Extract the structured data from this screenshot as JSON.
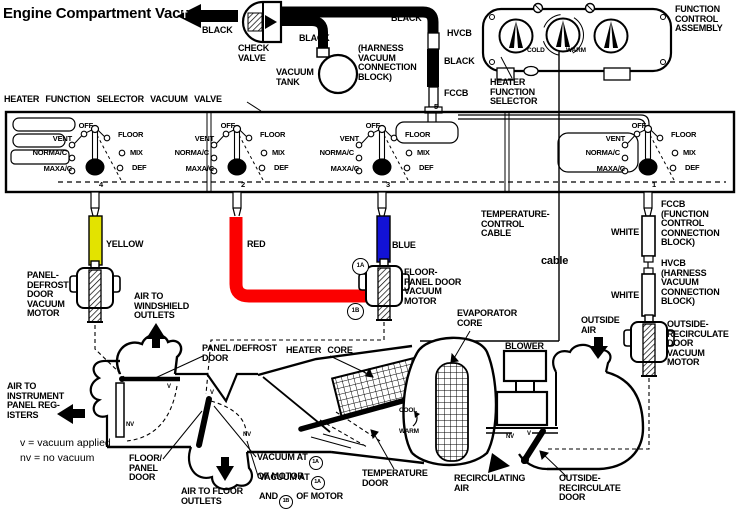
{
  "title": "Engine Compartment Vacuum",
  "colors": {
    "yellow": "#e3e300",
    "red": "#fb0000",
    "blue": "#1212d6",
    "line": "#000000"
  },
  "engine": {
    "arrow_letter": "T",
    "black_hose": "BLACK",
    "check_valve": "CHECK\nVALVE",
    "tank_hose_black": "BLACK",
    "vacuum_tank": "VACUUM\nTANK",
    "harness_block": "(HARNESS\nVACUUM\nCONNECTION\nBLOCK)",
    "supply_black": "BLACK",
    "hvcb": "HVCB",
    "hvcb_black": "BLACK",
    "fccb": "FCCB"
  },
  "control_assembly": {
    "name": "FUNCTION\nCONTROL\nASSEMBLY",
    "cold": "COLD",
    "warm": "WARM",
    "selector": "HEATER\nFUNCTION\nSELECTOR"
  },
  "valve_box": {
    "title": "HEATER FUNCTION SELECTOR VACUUM VALVE",
    "labels": {
      "off": "OFF",
      "vent": "VENT",
      "norm_ac": "NORMA/C",
      "max_ac": "MAXA/C",
      "floor": "FLOOR",
      "mix": "MIX",
      "def": "DEF"
    },
    "ports": [
      "4",
      "2",
      "3",
      "1"
    ],
    "top_port": "5"
  },
  "hoses": {
    "yellow": "YELLOW",
    "red": "RED",
    "blue": "BLUE",
    "white_upper": "WHITE",
    "white_lower": "WHITE"
  },
  "connection_blocks": {
    "fccb": "FCCB\n(FUNCTION\nCONTROL\nCONNECTION\nBLOCK)",
    "hvcb": "HVCB\n(HARNESS\nVACUUM\nCONNECTION\nBLOCK)"
  },
  "cable": {
    "label": "TEMPERATURE-\nCONTROL\nCABLE",
    "short": "cable"
  },
  "motors": {
    "panel_defrost": "PANEL-\nDEFROST\nDOOR\nVACUUM\nMOTOR",
    "floor_panel": "FLOOR-\nPANEL DOOR\nVACUUM\nMOTOR",
    "outside_recirc": "OUTSIDE-\nRECIRCULATE\nDOOR\nVACUUM\nMOTOR",
    "port_a": "1A",
    "port_b": "1B"
  },
  "airflow": {
    "windshield": "AIR TO\nWINDSHIELD\nOUTLETS",
    "registers": "AIR TO\nINSTRUMENT\nPANEL REG-\nISTERS",
    "floor": "AIR TO FLOOR\nOUTLETS",
    "outside": "OUTSIDE\nAIR",
    "recirculating": "RECIRCULATING\nAIR"
  },
  "case_parts": {
    "panel_defrost_door": "PANEL /DEFROST\nDOOR",
    "floor_panel_door": "FLOOR/\nPANEL\nDOOR",
    "heater_core": "HEATER CORE",
    "evaporator_core": "EVAPORATOR\nCORE",
    "blower": "BLOWER",
    "temperature_door": "TEMPERATURE\nDOOR",
    "outside_recirc_door": "OUTSIDE-\nRECIRCULATE\nDOOR",
    "cool": "COOL",
    "warm": "WARM"
  },
  "legend": {
    "vacuum": "v = vacuum applied",
    "no_vacuum": "nv = no vacuum"
  },
  "door_states": {
    "v": "V",
    "nv": "NV"
  },
  "vacuum_notes": {
    "note1_pre": "VACUUM AT",
    "note1_post": "OF MOTOR",
    "note2_pre": "VACUUM AT",
    "note2_mid": "AND",
    "note2_post": "OF MOTOR"
  }
}
